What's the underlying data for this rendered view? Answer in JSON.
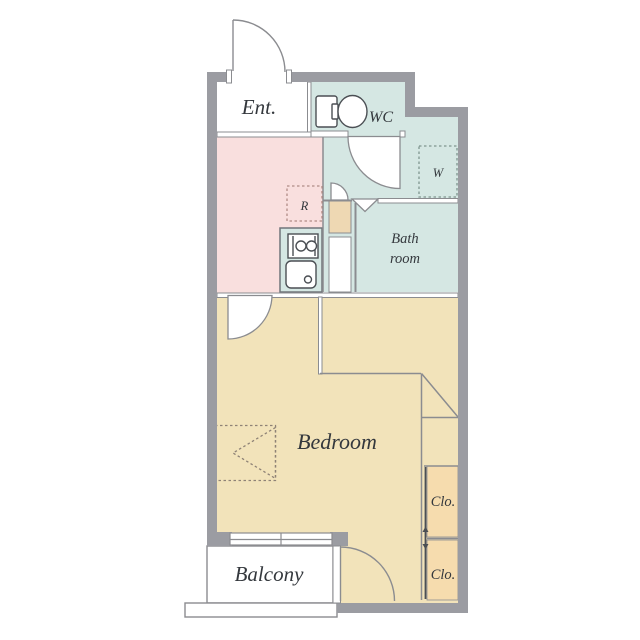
{
  "plan": {
    "rooms": {
      "entrance": "Ent.",
      "toilet": "WC",
      "bath_line1": "Bath",
      "bath_line2": "room",
      "bedroom": "Bedroom",
      "balcony": "Balcony",
      "closet_upper": "Clo.",
      "closet_lower": "Clo."
    },
    "appliances": {
      "washer": "W",
      "refrigerator": "R"
    }
  },
  "colors": {
    "wall": "#9b9ca2",
    "line": "#8b8c90",
    "teal": "#d5e7e3",
    "pink": "#f9dfde",
    "tan": "#f2e3ba",
    "peach": "#f6dcae",
    "boxtan": "#eed8b3",
    "text": "#34383d",
    "icon": "#4b4f54",
    "dashr": "#b08c86",
    "dashw": "#7f958f",
    "dashbay": "#8e8276"
  }
}
